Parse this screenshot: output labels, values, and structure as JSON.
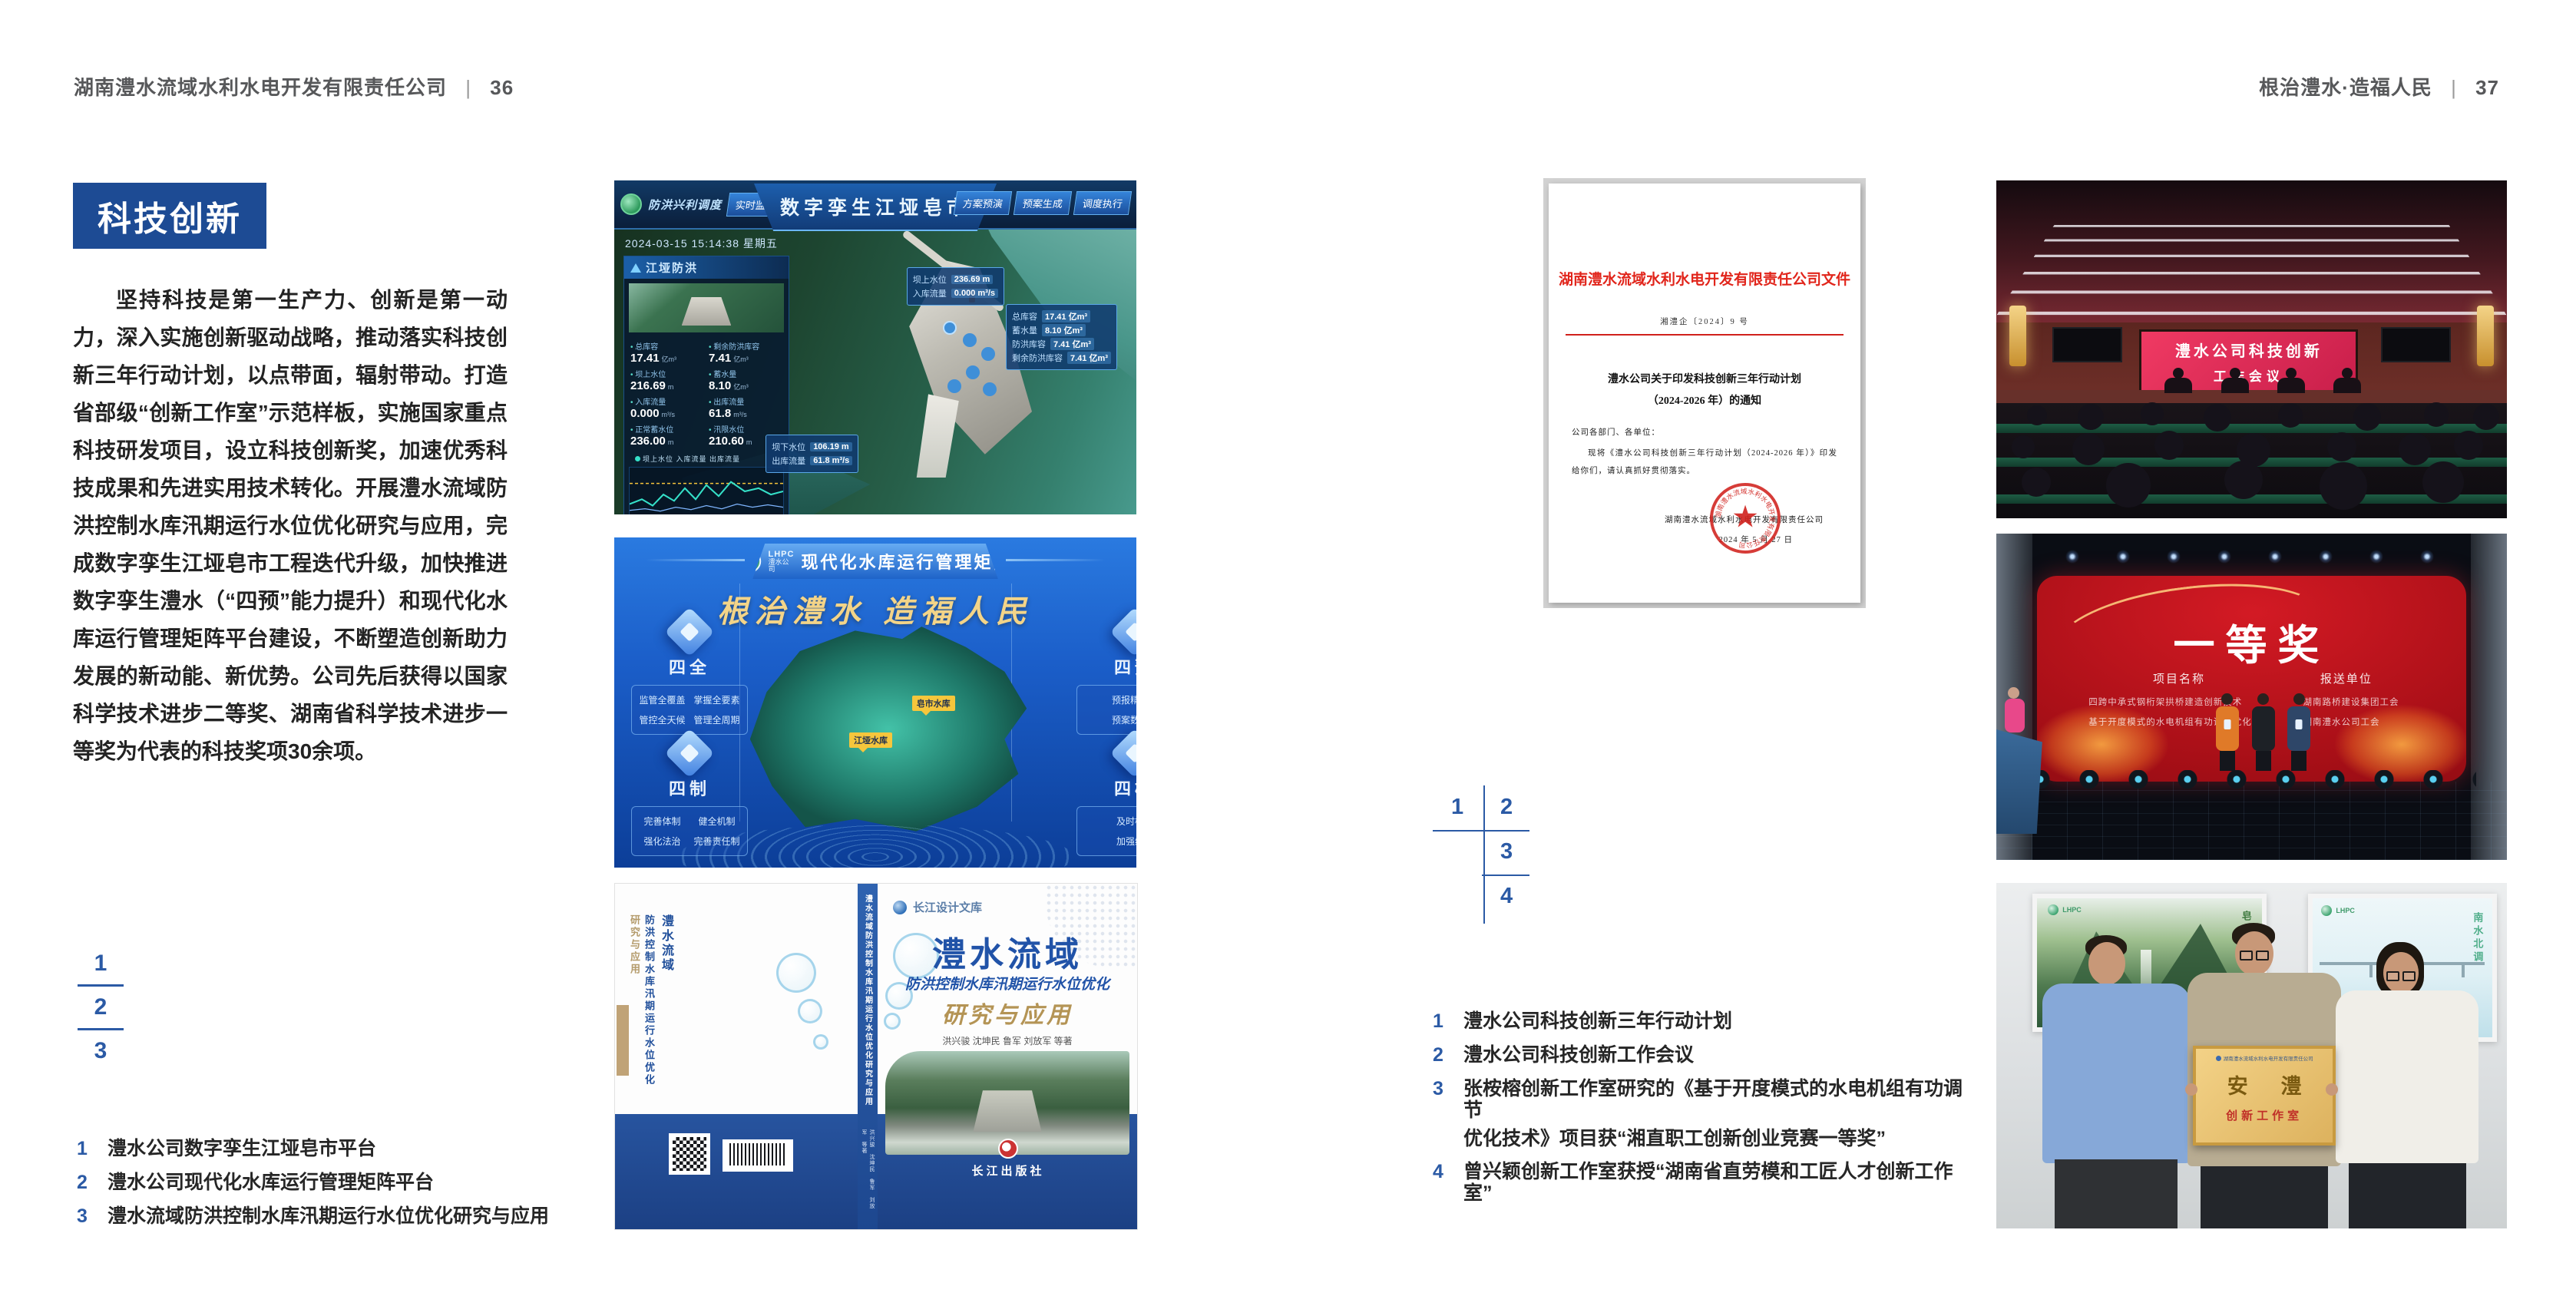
{
  "header_left": {
    "company": "湖南澧水流域水利水电开发有限责任公司",
    "sep": "|",
    "page": "36"
  },
  "header_right": {
    "motto": "根治澧水·造福人民",
    "sep": "|",
    "page": "37"
  },
  "left": {
    "badge": "科技创新",
    "paragraph": "坚持科技是第一生产力、创新是第一动力，深入实施创新驱动战略，推动落实科技创新三年行动计划，以点带面，辐射带动。打造省部级“创新工作室”示范样板，实施国家重点科技研发项目，设立科技创新奖，加速优秀科技成果和先进实用技术转化。开展澧水流域防洪控制水库汛期运行水位优化研究与应用，完成数字孪生江垭皂市工程迭代升级，加快推进数字孪生澧水（“四预”能力提升）和现代化水库运行管理矩阵平台建设，不断塑造创新助力发展的新动能、新优势。公司先后获得以国家科学技术进步二等奖、湖南省科学技术进步一等奖为代表的科技奖项30余项。",
    "keys": [
      "1",
      "2",
      "3"
    ],
    "captions": [
      {
        "n": "1",
        "t": "澧水公司数字孪生江垭皂市平台"
      },
      {
        "n": "2",
        "t": "澧水公司现代化水库运行管理矩阵平台"
      },
      {
        "n": "3",
        "t": "澧水流域防洪控制水库汛期运行水位优化研究与应用"
      }
    ]
  },
  "right": {
    "keys": [
      "1",
      "2",
      "3",
      "4"
    ],
    "captions": [
      {
        "n": "1",
        "t": "澧水公司科技创新三年行动计划"
      },
      {
        "n": "2",
        "t": "澧水公司科技创新工作会议"
      },
      {
        "n": "3",
        "t": "张桉榕创新工作室研究的《基于开度模式的水电机组有功调节",
        "t2": "优化技术》项目获“湘直职工创新创业竞赛一等奖”"
      },
      {
        "n": "4",
        "t": "曾兴颖创新工作室获授“湖南省直劳模和工匠人才创新工作室”"
      }
    ]
  },
  "dashboard": {
    "module": "防洪兴利调度",
    "nav_left": [
      "实时监测",
      "洪水预报",
      "防洪预警"
    ],
    "title": "数字孪生江垭皂市",
    "nav_right": [
      "方案预演",
      "预案生成",
      "调度执行"
    ],
    "timestamp": "2024-03-15 15:14:38 星期五",
    "panel1": {
      "title": "江垭防洪",
      "stats": [
        {
          "l": "总库容",
          "v": "17.41",
          "u": "亿m³"
        },
        {
          "l": "剩余防洪库容",
          "v": "7.41",
          "u": "亿m³"
        },
        {
          "l": "坝上水位",
          "v": "216.69",
          "u": "m"
        },
        {
          "l": "蓄水量",
          "v": "8.10",
          "u": "亿m³"
        },
        {
          "l": "入库流量",
          "v": "0.000",
          "u": "m³/s"
        },
        {
          "l": "出库流量",
          "v": "61.8",
          "u": "m³/s"
        },
        {
          "l": "正常蓄水位",
          "v": "236.00",
          "u": "m"
        },
        {
          "l": "汛限水位",
          "v": "210.60",
          "u": "m"
        }
      ]
    },
    "legend": "坝上水位 入库流量 出库流量",
    "panel2": {
      "title": "江垭发电",
      "stats": [
        {
          "l": "年发电计划",
          "v": "6.3000",
          "u": "亿度"
        },
        {
          "l": "年累计发电量",
          "v": "2907",
          "u": "万度"
        },
        {
          "l": "月累计发电量",
          "v": "3359.21",
          "u": "万度"
        },
        {
          "l": "当前出力",
          "v": "0.00",
          "u": "MW"
        }
      ]
    },
    "tip_top": [
      {
        "l": "坝上水位",
        "v": "236.69 m"
      },
      {
        "l": "入库流量",
        "v": "0.000 m³/s"
      }
    ],
    "tip_right": [
      {
        "l": "总库容",
        "v": "17.41 亿m³"
      },
      {
        "l": "蓄水量",
        "v": "8.10 亿m³"
      },
      {
        "l": "防洪库容",
        "v": "7.41 亿m³"
      },
      {
        "l": "剩余防洪库容",
        "v": "7.41 亿m³"
      }
    ],
    "tip_bottom": [
      {
        "l": "坝下水位",
        "v": "106.19 m"
      },
      {
        "l": "出库流量",
        "v": "61.8 m³/s"
      }
    ]
  },
  "platform": {
    "logo_abbr": "LHPC",
    "logo_sub": "澧水公司",
    "title": "现代化水库运行管理矩阵",
    "slogan": "根治澧水  造福人民",
    "panels": [
      {
        "title": "四全",
        "items": [
          "监管全覆盖",
          "掌握全要素",
          "管控全天候",
          "管理全周期"
        ]
      },
      {
        "title": "四制",
        "items": [
          "完善体制",
          "健全机制",
          "强化法治",
          "完善责任制"
        ]
      },
      {
        "title": "四预",
        "items": [
          "预报精准化",
          "预案数字化"
        ]
      },
      {
        "title": "四检",
        "items": [
          "及时检验",
          "加强维护"
        ]
      }
    ],
    "map_labels": [
      "皂市水库",
      "江垭水库"
    ]
  },
  "book": {
    "brand": "长江设计文库",
    "title": "澧水流域",
    "subtitle": "防洪控制水库汛期运行水位优化",
    "tail": "研究与应用",
    "authors": "洪兴骏  沈坤民  鲁军  刘放军  等著",
    "spine": "澧水流域防洪控制水库汛期运行水位优化研究与应用",
    "publisher": "长江出版社"
  },
  "doc": {
    "header": "湖南澧水流域水利水电开发有限责任公司文件",
    "no": "湘澧企〔2024〕9 号",
    "title1": "澧水公司关于印发科技创新三年行动计划",
    "title2": "（2024-2026 年）的通知",
    "salute": "公司各部门、各单位：",
    "body": "现将《澧水公司科技创新三年行动计划（2024-2026 年）》印发给你们，请认真抓好贯彻落实。",
    "signer": "湖南澧水流域水利水电开发有限责任公司",
    "date": "2024 年 5 月 27 日",
    "seal_text": "湖南澧水流域水利水电开发有限责任公司"
  },
  "meeting": {
    "line1": "澧水公司科技创新",
    "line2": "工作会议"
  },
  "award": {
    "title": "一等奖",
    "col1": "项目名称",
    "col2": "报送单位",
    "rows": [
      {
        "p": "四跨中承式钢桁架拱桥建造创新技术",
        "u": "湖南路桥建设集团工会"
      },
      {
        "p": "基于开度模式的水电机组有功调节优化技术",
        "u": "湖南澧水公司工会"
      }
    ]
  },
  "studio": {
    "poster1_label": "皂市水库",
    "poster2_label": "南水北调",
    "logo_abbr": "LHPC",
    "plaque_org": "湖南澧水流域水利水电开发有限责任公司",
    "plaque_main": "安 澧",
    "plaque_sub": "创新工作室"
  }
}
